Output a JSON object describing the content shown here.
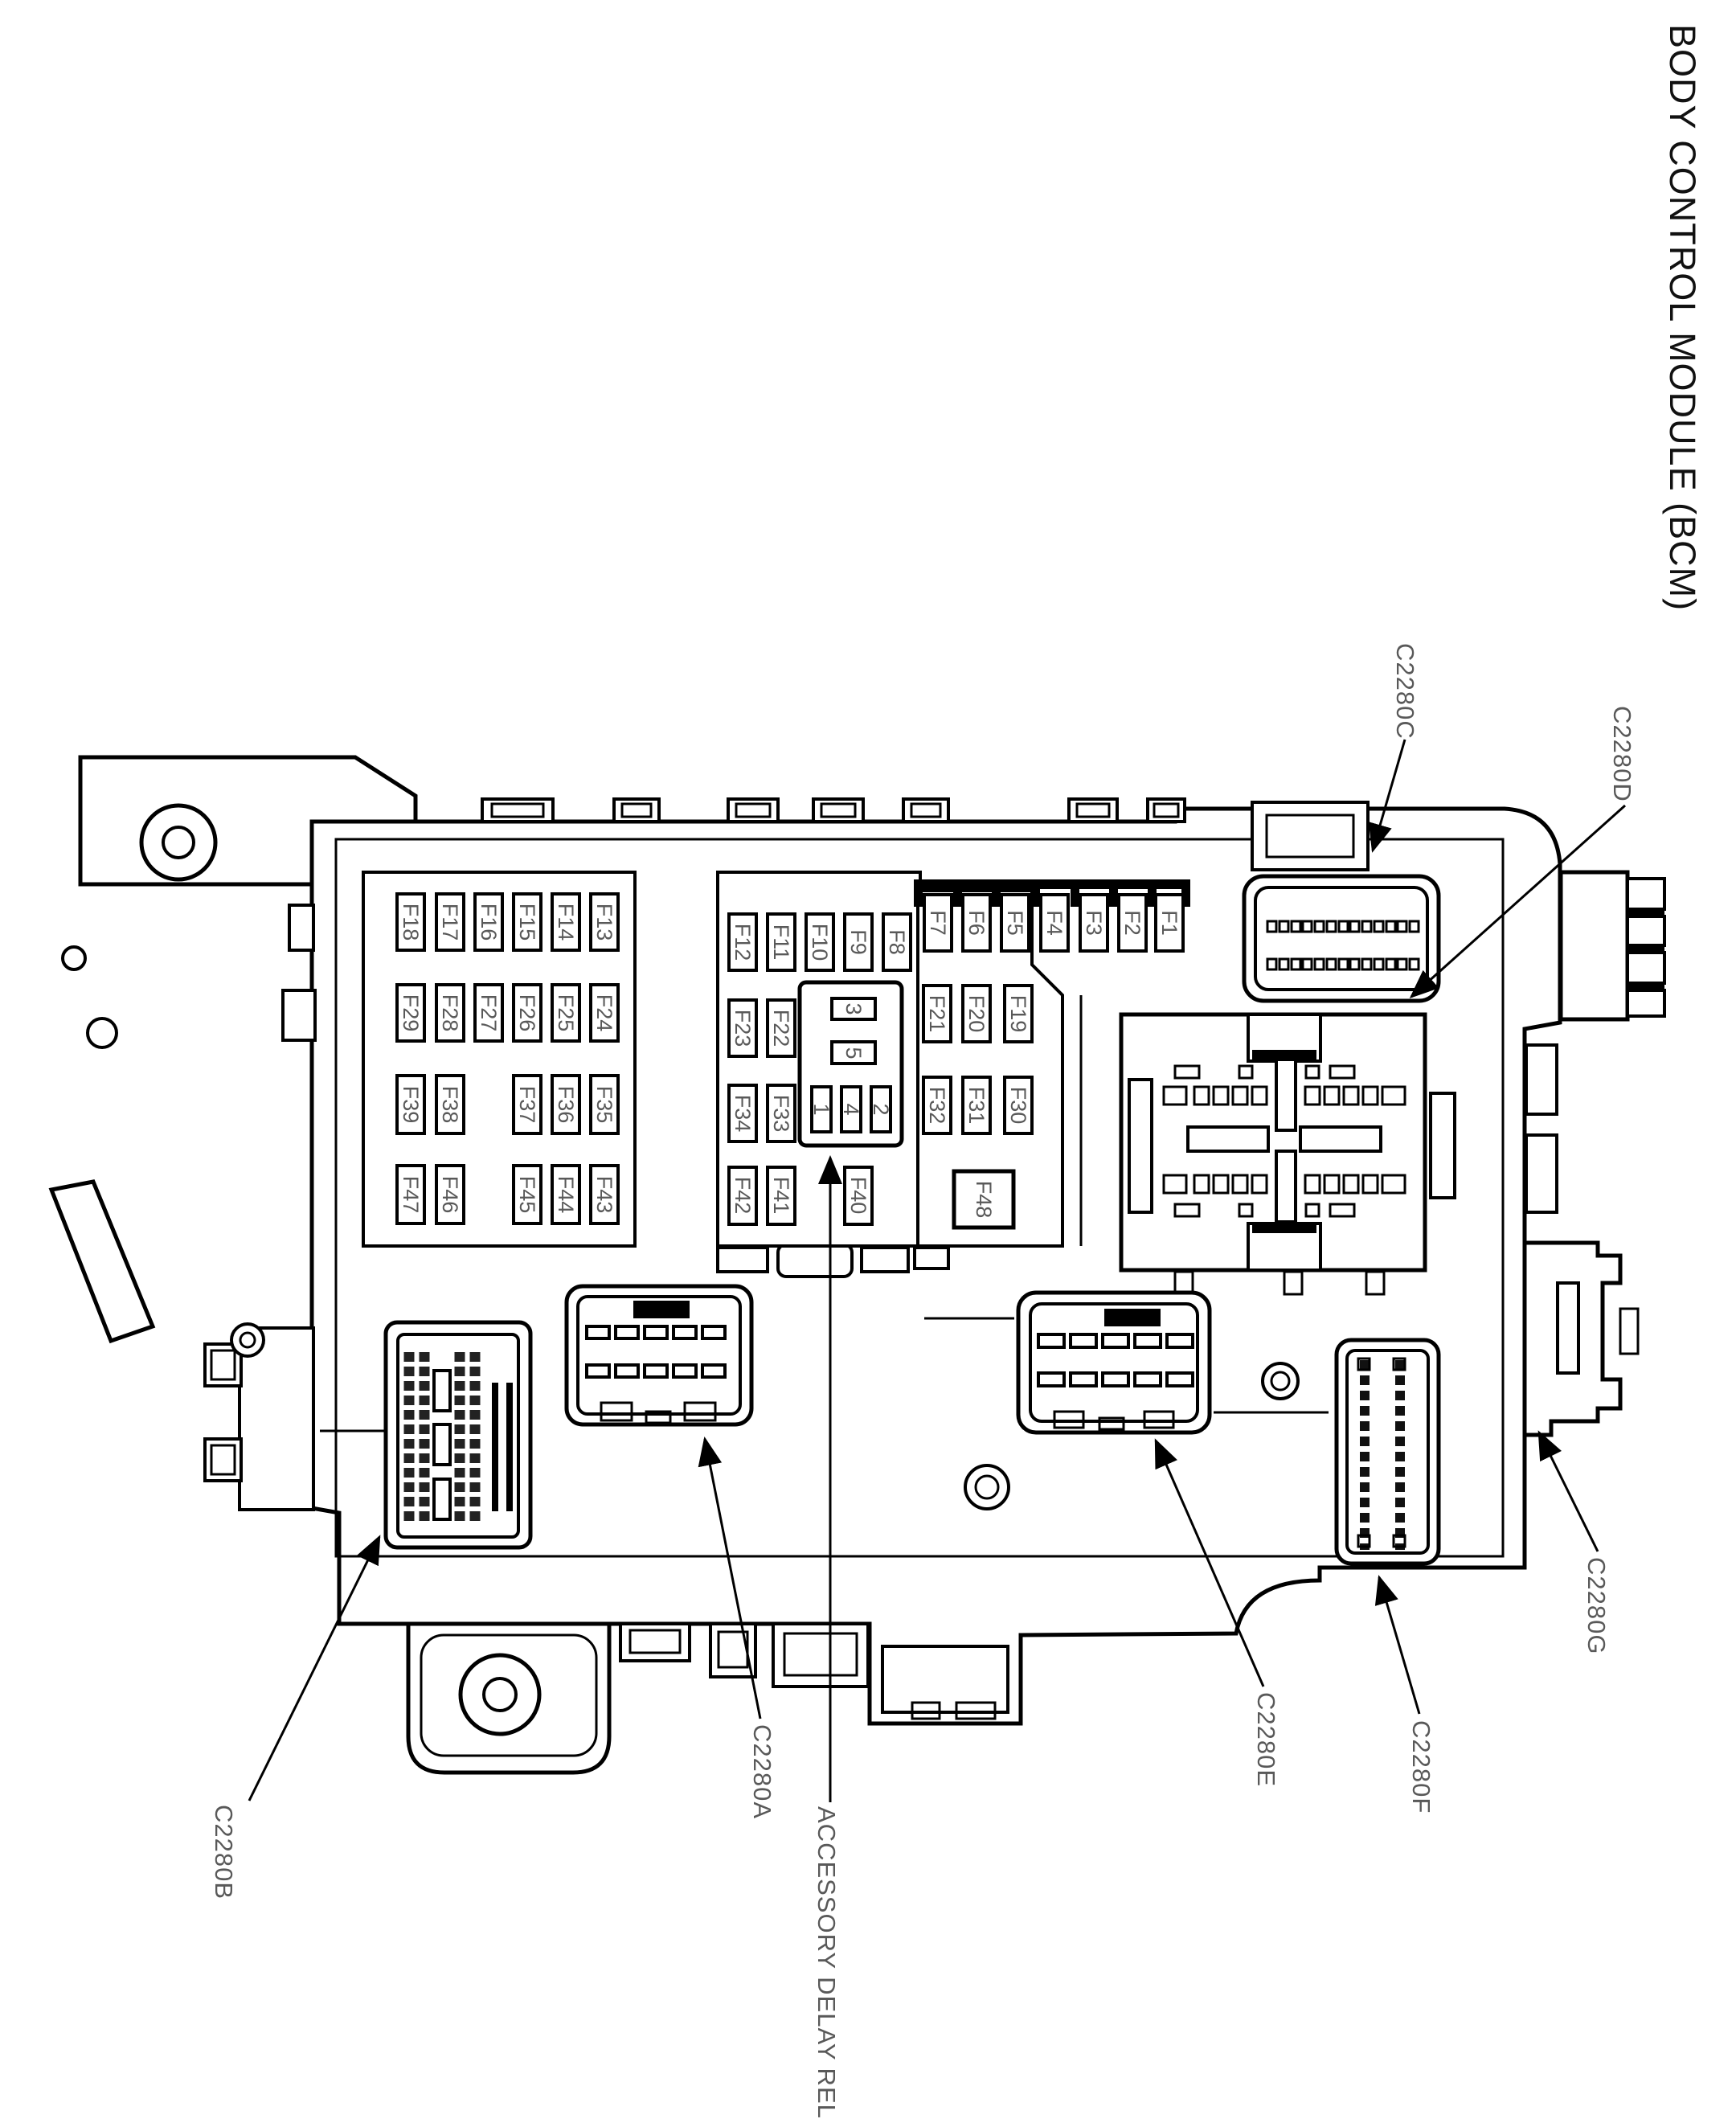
{
  "title": "BODY CONTROL MODULE (BCM)",
  "fuse_blocks": {
    "left": [
      [
        "F18",
        "F17",
        "F16",
        "F15",
        "F14",
        "F13"
      ],
      [
        "F29",
        "F28",
        "F27",
        "F26",
        "F25",
        "F24"
      ],
      [
        "F39",
        "F38",
        "F37",
        "F36",
        "F35"
      ],
      [
        "F47",
        "F46",
        "F45",
        "F44",
        "F43"
      ]
    ],
    "middle": [
      [
        "F12",
        "F11",
        "F10",
        "F9",
        "F8"
      ],
      [
        "F23",
        "F22"
      ],
      [
        "F34",
        "F33"
      ],
      [
        "F42",
        "F41",
        "F40"
      ]
    ],
    "right": [
      [
        "F7",
        "F6",
        "F5",
        "F4",
        "F3",
        "F2",
        "F1"
      ],
      [
        "F21",
        "F20",
        "F19"
      ],
      [
        "F32",
        "F31",
        "F30"
      ],
      [
        "F48"
      ]
    ]
  },
  "relay_slots": [
    "3",
    "5",
    "1",
    "4",
    "2"
  ],
  "callouts": {
    "c2280c": "C2280C",
    "c2280d": "C2280D",
    "c2280g": "C2280G",
    "c2280f": "C2280F",
    "c2280e": "C2280E",
    "c2280a": "C2280A",
    "c2280b": "C2280B",
    "accessory_delay_relay": "ACCESSORY DELAY RELAY"
  },
  "colors": {
    "line": "#000000",
    "label_gray": "#595959",
    "background": "#ffffff"
  }
}
